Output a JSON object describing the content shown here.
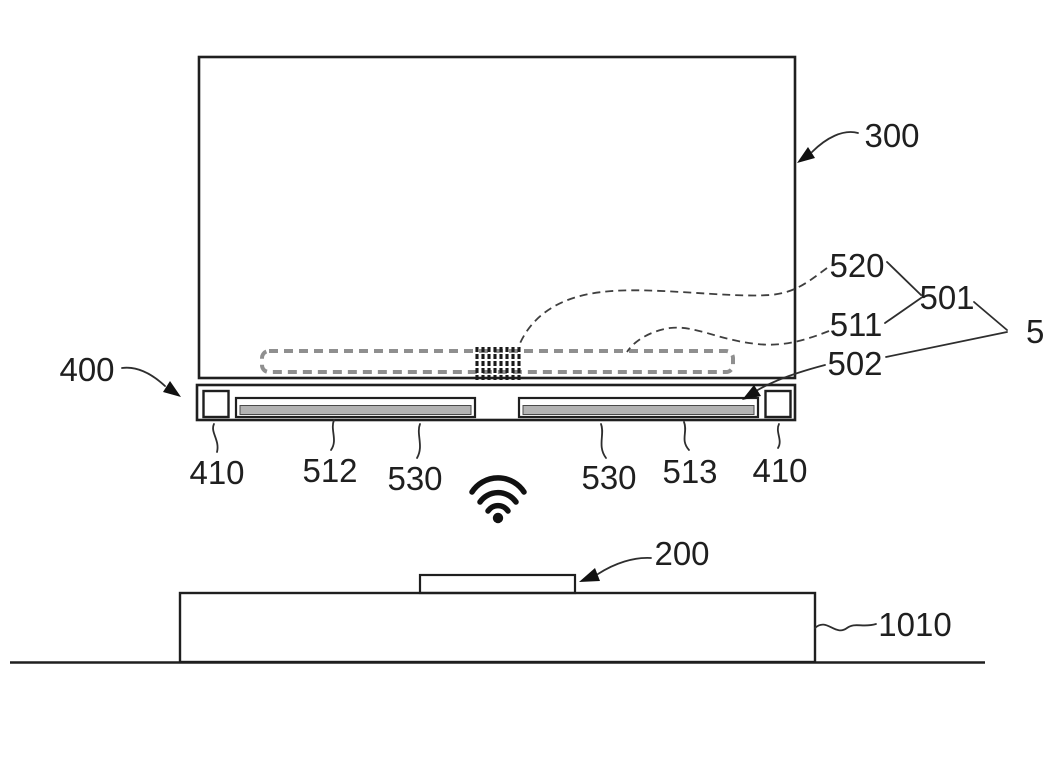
{
  "figure": {
    "labels": {
      "ref_300": "300",
      "ref_400": "400",
      "ref_520": "520",
      "ref_501": "501",
      "ref_511": "511",
      "ref_502": "502",
      "ref_5": "5",
      "ref_410_left": "410",
      "ref_512": "512",
      "ref_530_left": "530",
      "ref_530_right": "530",
      "ref_513": "513",
      "ref_410_right": "410",
      "ref_200": "200",
      "ref_1010": "1010"
    },
    "icons": {
      "wireless": "wifi-signal-icon"
    },
    "colors": {
      "line": "#1f1f1f",
      "dashed_outline": "#8f8f8f",
      "bar_fill": "#b3b3b3"
    }
  }
}
